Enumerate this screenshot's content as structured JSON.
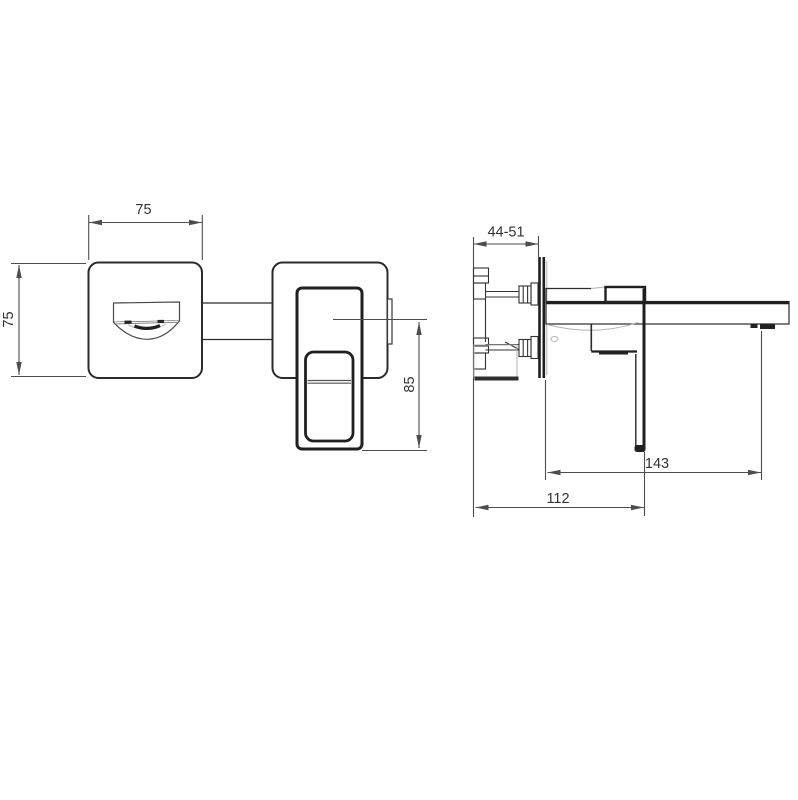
{
  "drawing": {
    "kind": "technical-dimension-drawing",
    "subject": "wall-mounted-basin-mixer-tap",
    "views": {
      "front": "front-view",
      "side": "side-view"
    }
  },
  "dims": {
    "front_width": "75",
    "front_height": "75",
    "handle_drop": "85",
    "install_depth": "44-51",
    "spout_reach": "143",
    "body_depth": "112"
  },
  "colors": {
    "background": "#ffffff",
    "line": "#2b2b2b",
    "line_bold": "#1f1f1f",
    "line_light": "#b3b3b3",
    "dimension": "#4d4d4d",
    "text": "#333333"
  }
}
